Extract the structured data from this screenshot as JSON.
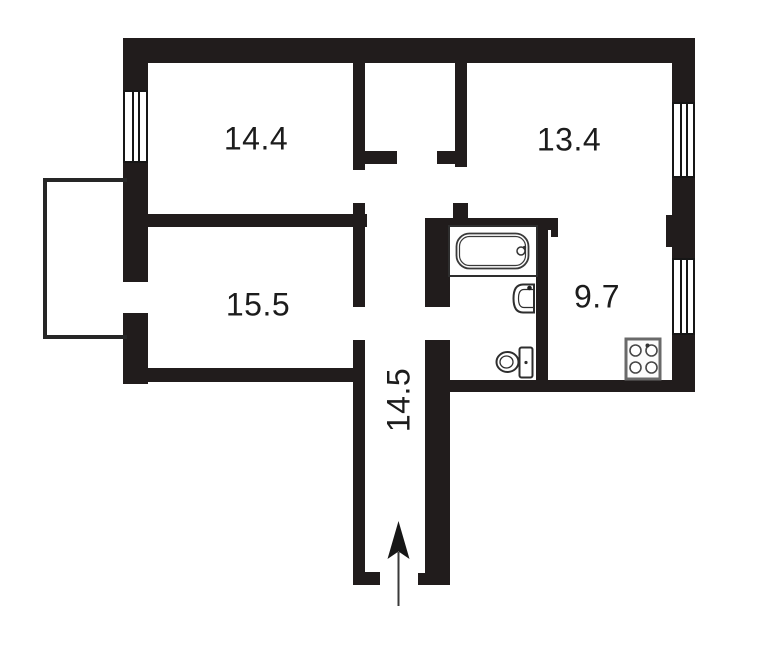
{
  "floorplan": {
    "rooms": [
      {
        "id": "room-top-left",
        "area_label": "14.4"
      },
      {
        "id": "room-top-right",
        "area_label": "13.4"
      },
      {
        "id": "room-mid-left",
        "area_label": "15.5"
      },
      {
        "id": "kitchen",
        "area_label": "9.7"
      },
      {
        "id": "hallway",
        "area_label": "14.5"
      }
    ],
    "fixtures": [
      "bathtub-icon",
      "sink-icon",
      "toilet-icon",
      "stove-icon",
      "entrance-arrow-icon"
    ],
    "window_count": 3,
    "colors": {
      "wall": "#211c1c",
      "balcony_outline": "#262626",
      "fixture_outline": "#2e2e2e",
      "stove_outline": "#6a6a6a",
      "label_text": "#1c1c1c",
      "background": "#ffffff"
    }
  }
}
